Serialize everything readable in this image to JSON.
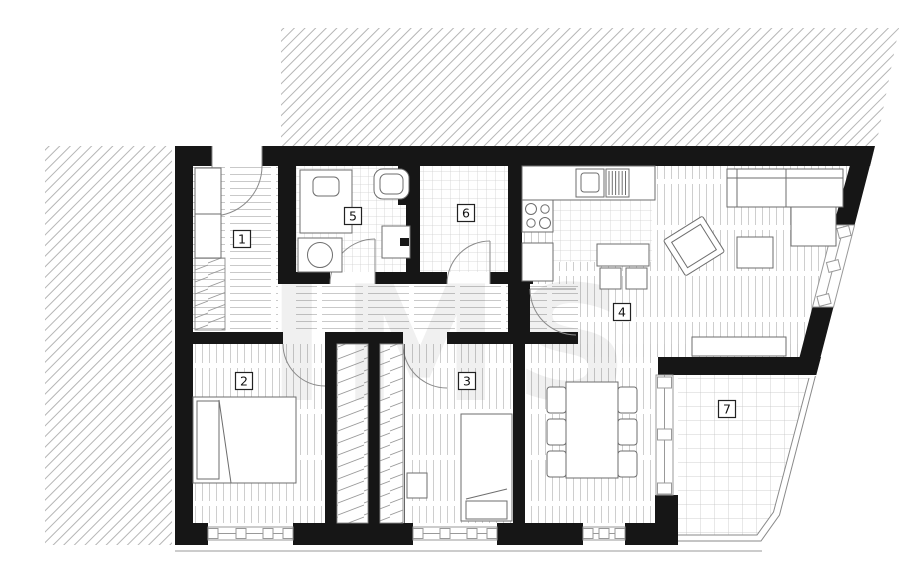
{
  "plan": {
    "watermark": "IMS",
    "room_labels": [
      {
        "id": "1"
      },
      {
        "id": "2"
      },
      {
        "id": "3"
      },
      {
        "id": "4"
      },
      {
        "id": "5"
      },
      {
        "id": "6"
      },
      {
        "id": "7"
      }
    ],
    "colors": {
      "wall": "#161616",
      "exterior_hatch": "#b5b5b5",
      "floor_plank_line": "#c9c9c9",
      "tile_grid_line": "#cfcfcf",
      "fixture_line": "#6e6e6e",
      "door_arc": "#8a8a8a",
      "window_frame": "#999999",
      "label_border": "#222222"
    }
  }
}
